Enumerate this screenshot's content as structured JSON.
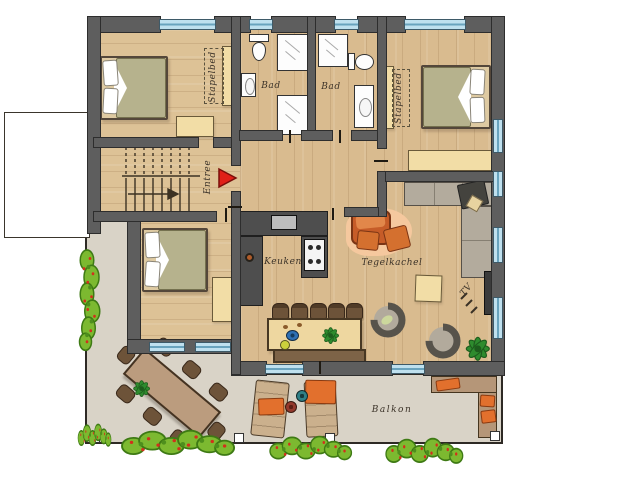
{
  "labels": {
    "bunk_left": "Stapelbed",
    "bunk_right": "Stapelbed",
    "bath_left": "Bad",
    "bath_right": "Bad",
    "entrance": "Entree",
    "kitchen": "Keuken",
    "tile_stove": "Tegelkachel",
    "tv": "TV",
    "balcony": "Balkon"
  },
  "colors": {
    "wall": "#5e5e5e",
    "wood_floor": "#d9bb8f",
    "balcony_floor": "#d9d3c7",
    "window_glass": "#bfe0ee",
    "bed_duvet": "#b6b28d",
    "furniture_tan": "#f2dda6",
    "kitchen_counter": "#4e4e4e",
    "tile_stove_orange": "#c65c28",
    "sofa_gray": "#b3ab9d",
    "chair_brown": "#6d5339",
    "bush_green": "#7cb930",
    "flower_red": "#d2301c",
    "entrance_arrow_red": "#e02018",
    "label_ink": "#3b3228"
  },
  "icons": {
    "entrance-arrow-icon": "red triangle pointing right",
    "stairs-icon": "risers with direction arrow",
    "double-bed-icon": "bed with two pillows and duvet",
    "bunk-bed-icon": "solid rectangle with dashed upper bunk",
    "toilet-icon": "oval bowl with tank",
    "sink-icon": "rectangle with basin",
    "shower-icon": "square with glass lines",
    "cooktop-icon": "white square with four burners",
    "tile-stove-icon": "orange rounded stove with bench",
    "sofa-icon": "L-shaped sectional",
    "tv-icon": "wall mounted panel",
    "armchair-icon": "open ring tub chair",
    "plant-icon": "green leaf rosette",
    "flower-box-icon": "green hedge with red blossoms",
    "lounger-icon": "sun lounger with orange towel",
    "railing-post-icon": "white square post"
  }
}
